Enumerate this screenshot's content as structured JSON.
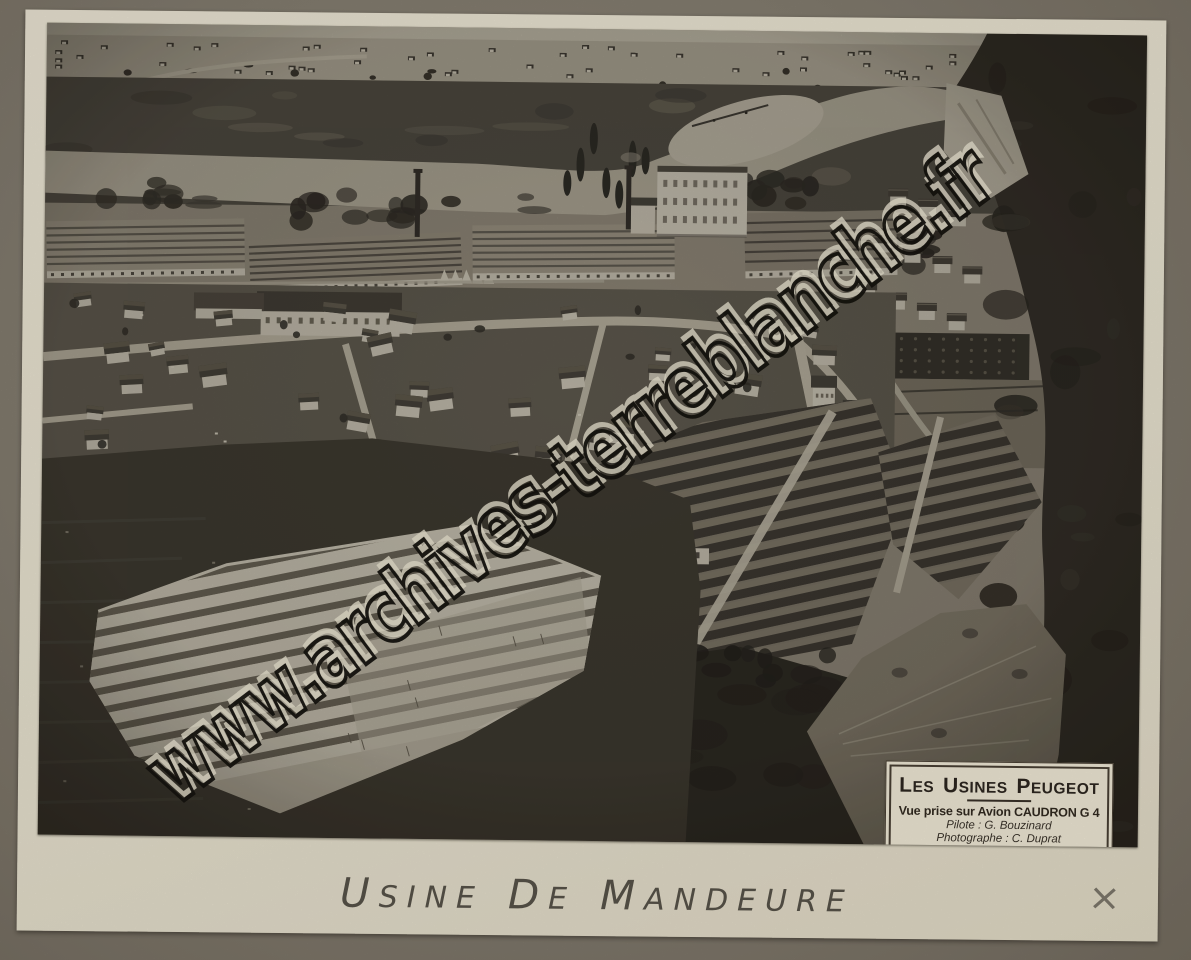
{
  "photo": {
    "watermark": "www.archives-terreblanche.fr",
    "plate": {
      "title_words": [
        "Les",
        "Usines",
        "Peugeot"
      ],
      "subtitle": "Vue prise sur Avion CAUDRON G 4",
      "pilot": "Pilote : G. Bouzinard",
      "photographer": "Photographe : C. Duprat"
    }
  },
  "caption": {
    "words": [
      "Usine",
      "de",
      "Mandeure"
    ]
  },
  "pencil_mark": "×"
}
